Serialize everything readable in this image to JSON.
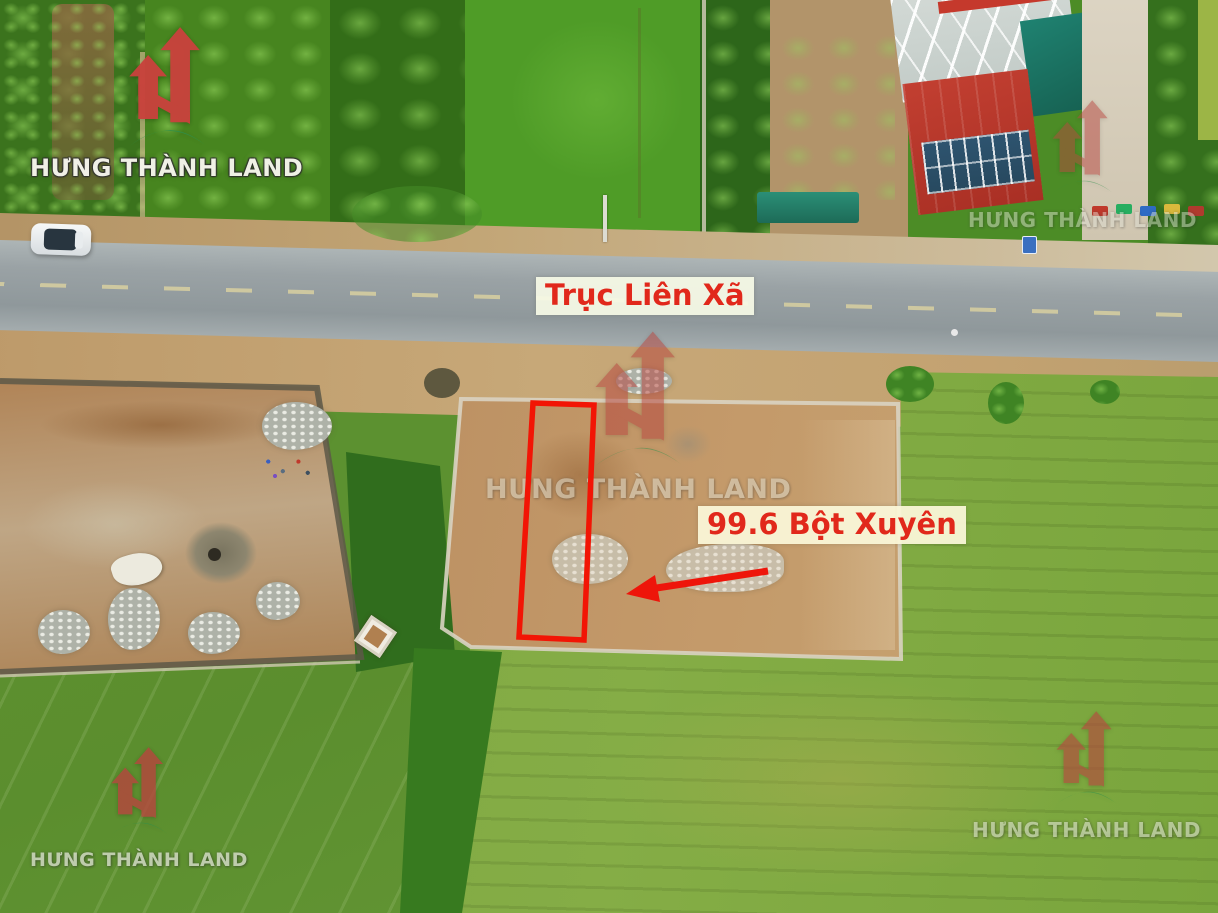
{
  "brand": {
    "name": "HƯNG THÀNH LAND",
    "logo_icon": "ht-buildings-arrow-icon",
    "logo_red": "#c8423c",
    "logo_green": "#2f8f4b",
    "wordmark_color": "#f5f4ec"
  },
  "annotations": {
    "road_label": "Trục Liên Xã",
    "plot_label": "99.6 Bột Xuyên",
    "plot_area_value": "99.6",
    "plot_area_unit": "m2",
    "plot_location": "Bột Xuyên",
    "plot_outline_color": "#f21505",
    "arrow_color": "#ee150a",
    "label_background": "#f8f8e2",
    "label_text_color": "#e1281b"
  }
}
